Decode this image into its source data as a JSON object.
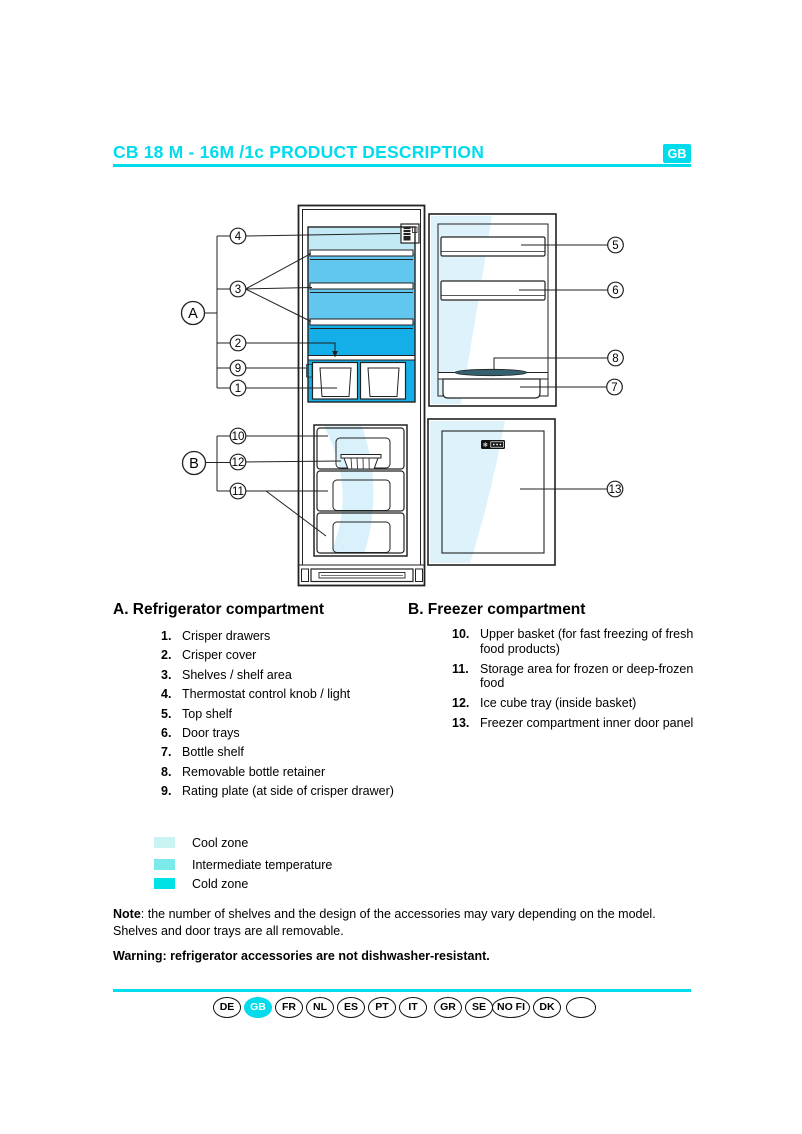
{
  "header": {
    "title": "CB 18 M - 16M /1c PRODUCT DESCRIPTION",
    "lang_badge": "GB"
  },
  "diagram": {
    "callouts": {
      "a": "A",
      "b": "B",
      "c1": "1",
      "c2": "2",
      "c3": "3",
      "c4": "4",
      "c5": "5",
      "c6": "6",
      "c7": "7",
      "c8": "8",
      "c9": "9",
      "c10": "10",
      "c11": "11",
      "c12": "12",
      "c13": "13"
    }
  },
  "sections": {
    "refrigerator": {
      "heading": "A. Refrigerator compartment",
      "items": [
        {
          "num": "1.",
          "text": "Crisper drawers"
        },
        {
          "num": "2.",
          "text": "Crisper cover"
        },
        {
          "num": "3.",
          "text": "Shelves / shelf area"
        },
        {
          "num": "4.",
          "text": "Thermostat control knob / light"
        },
        {
          "num": "5.",
          "text": "Top shelf"
        },
        {
          "num": "6.",
          "text": "Door trays"
        },
        {
          "num": "7.",
          "text": "Bottle shelf"
        },
        {
          "num": "8.",
          "text": "Removable bottle retainer"
        },
        {
          "num": "9.",
          "text": "Rating plate (at side of crisper drawer)"
        }
      ]
    },
    "freezer": {
      "heading": "B. Freezer compartment",
      "items": [
        {
          "num": "10.",
          "text": "Upper basket (for fast freezing of fresh food products)"
        },
        {
          "num": "11.",
          "text": "Storage area for frozen or deep-frozen food"
        },
        {
          "num": "12.",
          "text": "Ice cube tray (inside basket)"
        },
        {
          "num": "13.",
          "text": "Freezer compartment inner door panel"
        }
      ]
    }
  },
  "legend": {
    "items": [
      {
        "label": "Cool zone",
        "color": "#c9f4f2"
      },
      {
        "label": "Intermediate temperature",
        "color": "#7ce9ea"
      },
      {
        "label": "Cold zone",
        "color": "#00e2e6"
      }
    ]
  },
  "notes": {
    "note_label": "Note",
    "note_text": ": the number of shelves and the design of the accessories may vary depending on the model.",
    "note_line2": "Shelves and door trays are all removable.",
    "warning": "Warning: refrigerator accessories are not dishwasher-resistant."
  },
  "footer": {
    "languages": [
      "DE",
      "GB",
      "FR",
      "NL",
      "ES",
      "PT",
      "IT",
      "GR",
      "SE",
      "NO FI",
      "DK",
      ""
    ],
    "active": "GB"
  },
  "colors": {
    "accent_cyan": "#00dcec",
    "legend_cool": "#c9f4f2",
    "legend_intermediate": "#7ce9ea",
    "legend_cold": "#00e2e6",
    "diagram_cool": "#c2e9f5",
    "diagram_intermediate": "#62c7ee",
    "diagram_cold": "#14aee8"
  }
}
